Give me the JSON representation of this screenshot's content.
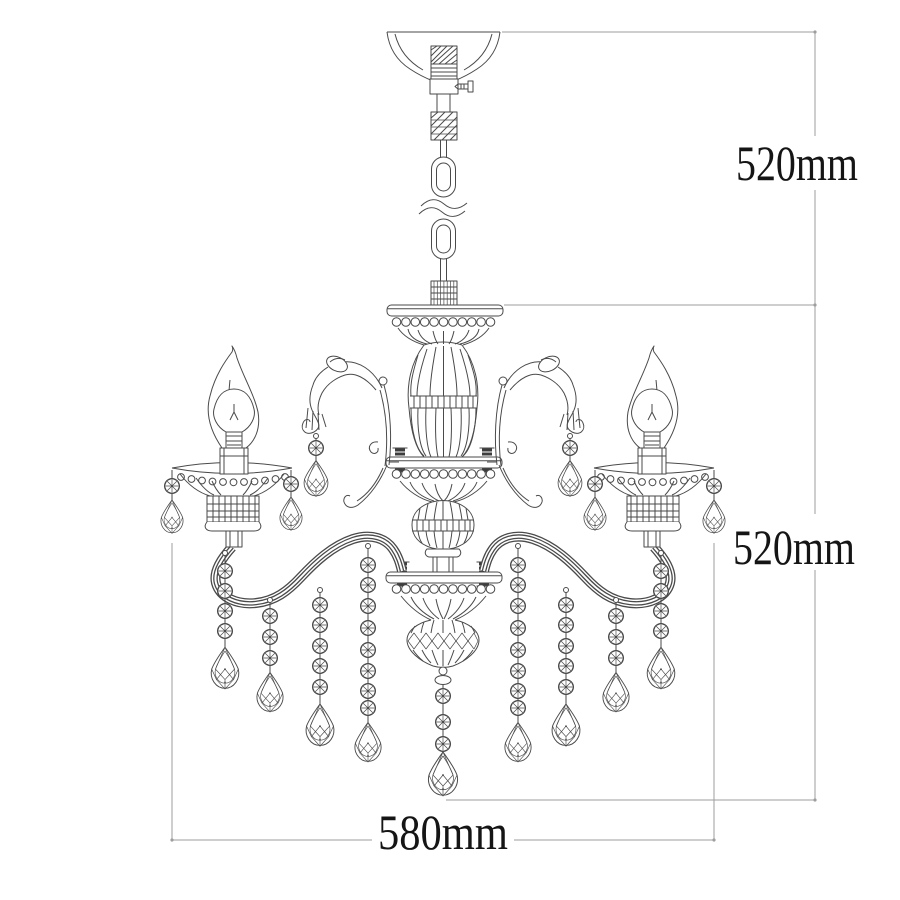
{
  "diagram": {
    "subject": "chandelier-technical-drawing",
    "dimensions": {
      "hanging_height": {
        "label": "520mm"
      },
      "fixture_height": {
        "label": "520mm"
      },
      "fixture_width": {
        "label": "580mm"
      }
    },
    "colors": {
      "background": "#ffffff",
      "drawing_line": "#4a4a4a",
      "dimension_line": "#9e9e9e",
      "label_text": "#151515"
    }
  }
}
